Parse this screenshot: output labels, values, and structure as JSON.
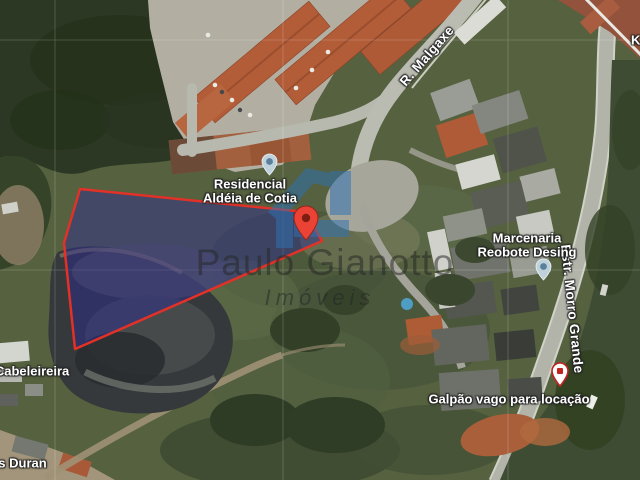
{
  "map": {
    "watermark": {
      "title": "Paulo Gianotto",
      "subtitle": "Imóveis"
    },
    "labels": {
      "residencial_line1": "Residencial",
      "residencial_line2": "Aldéia de Cotia",
      "road_malgaxe": "R. Malgaxe",
      "road_morro_grande": "Estr. Morro Grande",
      "marcenaria_line1": "Marcenaria",
      "marcenaria_line2": "Reobote Desing",
      "galpao": "Galpão vago para locação",
      "cabeleireira": "a Cabeleireira",
      "duran": "res Duran",
      "clipped_right": "K"
    },
    "colors": {
      "parcel_fill": "#2d2a96",
      "parcel_border": "#e23127",
      "red_pin": "#EA4335",
      "poi_marker": "#bfd2dc",
      "business_pin": "#c5221f",
      "logo_blue": "#2e72b4"
    }
  }
}
